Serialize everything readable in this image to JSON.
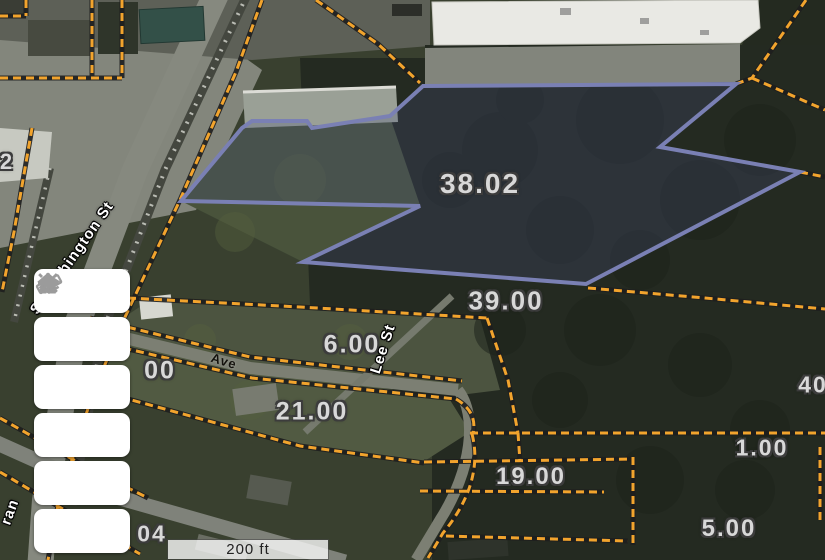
{
  "app": {
    "description_tag": "parcel-map-viewer"
  },
  "colors": {
    "parcel_line_orange": "#f2a42d",
    "parcel_line_casing": "#1e1e1e",
    "selected_parcel_stroke": "#7a80b4",
    "selected_parcel_fill": "rgba(70,78,130,0.25)",
    "parcel_label_text": "#d8d8d8",
    "street_label_text": "#ffffff",
    "toolbar_icon": "#9b9b9b",
    "scalebar_text": "#222222"
  },
  "toolbar": {
    "buttons": [
      {
        "name": "home",
        "icon": "home-icon"
      },
      {
        "name": "locate",
        "icon": "locate-icon"
      },
      {
        "name": "measure",
        "icon": "ruler-icon"
      },
      {
        "name": "zoom-in",
        "icon": "plus-icon"
      },
      {
        "name": "zoom-out",
        "icon": "minus-icon"
      },
      {
        "name": "layers",
        "icon": "layers-icon"
      }
    ]
  },
  "scalebar": {
    "label": "200 ft"
  },
  "map": {
    "selected_parcel": {
      "label": "38.02"
    },
    "parcel_labels": [
      {
        "text": "38.02",
        "x": 480,
        "y": 184,
        "size": 28
      },
      {
        "text": "39.00",
        "x": 506,
        "y": 301,
        "size": 26
      },
      {
        "text": "6.00",
        "x": 352,
        "y": 345,
        "size": 25
      },
      {
        "text": "00",
        "x": 160,
        "y": 371,
        "size": 25
      },
      {
        "text": "21.00",
        "x": 312,
        "y": 412,
        "size": 25
      },
      {
        "text": "19.00",
        "x": 531,
        "y": 477,
        "size": 24
      },
      {
        "text": "1.00",
        "x": 762,
        "y": 448,
        "size": 23
      },
      {
        "text": "40",
        "x": 813,
        "y": 385,
        "size": 23
      },
      {
        "text": "5.00",
        "x": 729,
        "y": 529,
        "size": 24
      },
      {
        "text": "04",
        "x": 152,
        "y": 534,
        "size": 23
      },
      {
        "text": "2",
        "x": 7,
        "y": 162,
        "size": 22
      }
    ],
    "street_labels": [
      {
        "text": "S Washington St",
        "x": 72,
        "y": 258,
        "angle": -55,
        "style": "light"
      },
      {
        "text": "Lee St",
        "x": 383,
        "y": 349,
        "angle": -72,
        "style": "light"
      },
      {
        "text": "ran",
        "x": 10,
        "y": 512,
        "angle": -70,
        "style": "light"
      },
      {
        "text": "Ave",
        "x": 224,
        "y": 361,
        "angle": 17,
        "style": "dark"
      }
    ]
  }
}
